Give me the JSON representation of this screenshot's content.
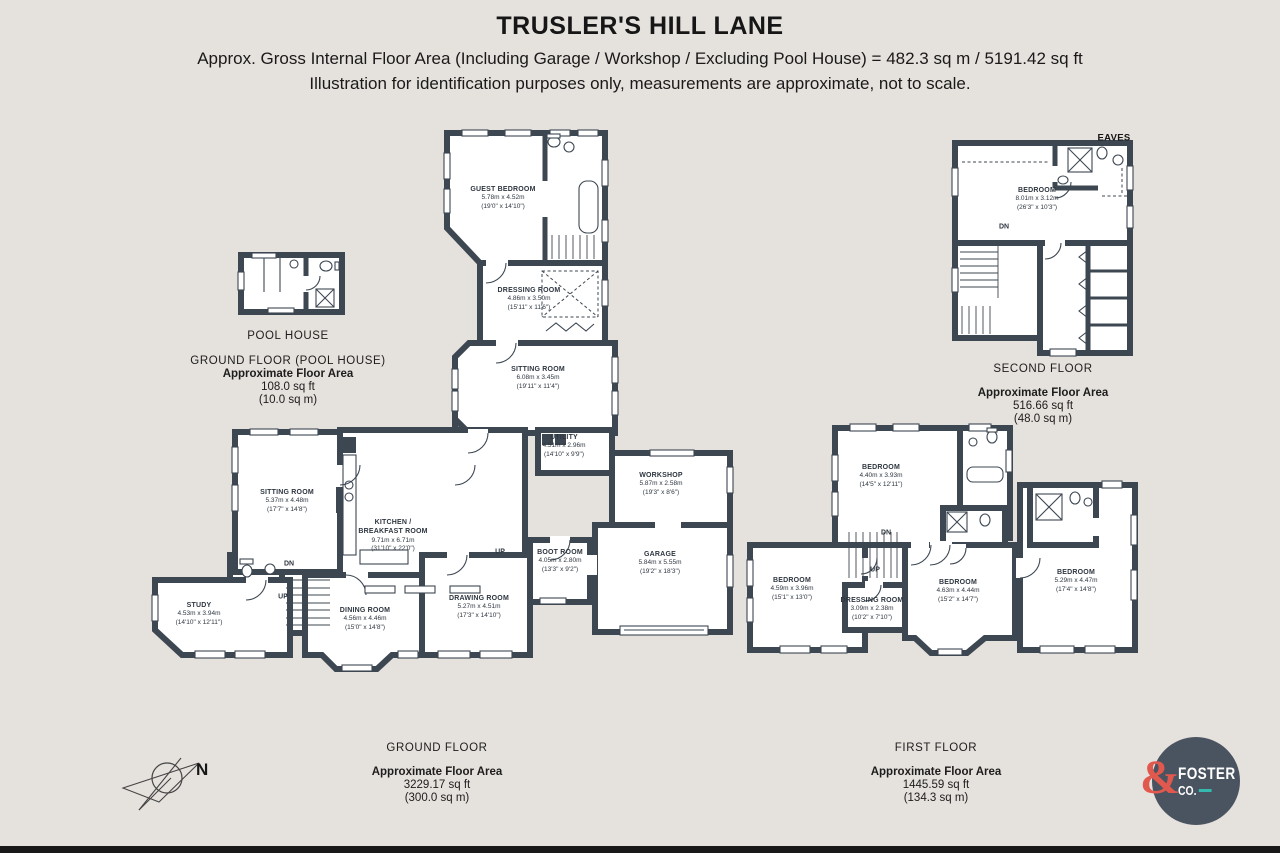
{
  "header": {
    "title": "TRUSLER'S HILL LANE",
    "line1": "Approx. Gross Internal Floor Area (Including Garage / Workshop / Excluding Pool House) = 482.3 sq m / 5191.42 sq ft",
    "line2": "Illustration for identification purposes only, measurements are approximate, not to scale."
  },
  "floors": {
    "pool_house": {
      "name": "POOL HOUSE",
      "floor_label": "GROUND FLOOR (POOL HOUSE)",
      "area_heading": "Approximate Floor Area",
      "area_ft": "108.0 sq ft",
      "area_m": "(10.0 sq m)"
    },
    "ground": {
      "floor_label": "GROUND FLOOR",
      "area_heading": "Approximate Floor Area",
      "area_ft": "3229.17 sq ft",
      "area_m": "(300.0 sq m)"
    },
    "first": {
      "floor_label": "FIRST FLOOR",
      "area_heading": "Approximate Floor Area",
      "area_ft": "1445.59 sq ft",
      "area_m": "(134.3 sq m)"
    },
    "second": {
      "floor_label": "SECOND FLOOR",
      "area_heading": "Approximate Floor Area",
      "area_ft": "516.66 sq ft",
      "area_m": "(48.0 sq m)"
    }
  },
  "rooms": {
    "guest_bedroom": {
      "name": "GUEST BEDROOM",
      "dims_m": "5.78m x 4.52m",
      "dims_ft": "(19'0\" x 14'10\")"
    },
    "dressing_gf": {
      "name": "DRESSING ROOM",
      "dims_m": "4.86m x 3.50m",
      "dims_ft": "(15'11\" x 11'6\")"
    },
    "sitting_mid": {
      "name": "SITTING ROOM",
      "dims_m": "6.08m x 3.45m",
      "dims_ft": "(19'11\" x 11'4\")"
    },
    "utility": {
      "name": "UTILITY",
      "dims_m": "4.51m x 2.96m",
      "dims_ft": "(14'10\" x 9'9\")"
    },
    "workshop": {
      "name": "WORKSHOP",
      "dims_m": "5.87m x 2.58m",
      "dims_ft": "(19'3\" x 8'6\")"
    },
    "sitting_left": {
      "name": "SITTING ROOM",
      "dims_m": "5.37m x 4.48m",
      "dims_ft": "(17'7\" x 14'8\")"
    },
    "kitchen": {
      "name": "KITCHEN / BREAKFAST ROOM",
      "dims_m": "9.71m x 6.71m",
      "dims_ft": "(31'10\" x 22'0\")"
    },
    "boot_room": {
      "name": "BOOT ROOM",
      "dims_m": "4.05m x 2.80m",
      "dims_ft": "(13'3\" x 9'2\")"
    },
    "garage": {
      "name": "GARAGE",
      "dims_m": "5.84m x 5.55m",
      "dims_ft": "(19'2\" x 18'3\")"
    },
    "study": {
      "name": "STUDY",
      "dims_m": "4.53m x 3.94m",
      "dims_ft": "(14'10\" x 12'11\")"
    },
    "dining": {
      "name": "DINING ROOM",
      "dims_m": "4.56m x 4.46m",
      "dims_ft": "(15'0\" x 14'8\")"
    },
    "drawing": {
      "name": "DRAWING ROOM",
      "dims_m": "5.27m x 4.51m",
      "dims_ft": "(17'3\" x 14'10\")"
    },
    "bedroom_second": {
      "name": "BEDROOM",
      "dims_m": "8.01m x 3.12m",
      "dims_ft": "(26'3\" x 10'3\")"
    },
    "bedroom_one": {
      "name": "BEDROOM",
      "dims_m": "4.40m x 3.93m",
      "dims_ft": "(14'5\" x 12'11\")"
    },
    "bedroom_two": {
      "name": "BEDROOM",
      "dims_m": "4.59m x 3.96m",
      "dims_ft": "(15'1\" x 13'0\")"
    },
    "dressing_ff": {
      "name": "DRESSING ROOM",
      "dims_m": "3.09m x 2.38m",
      "dims_ft": "(10'2\" x 7'10\")"
    },
    "bedroom_three": {
      "name": "BEDROOM",
      "dims_m": "4.63m x 4.44m",
      "dims_ft": "(15'2\" x 14'7\")"
    },
    "bedroom_four": {
      "name": "BEDROOM",
      "dims_m": "5.29m x 4.47m",
      "dims_ft": "(17'4\" x 14'8\")"
    }
  },
  "annotations": {
    "up": "UP",
    "dn": "DN",
    "eaves": "EAVES",
    "north": "N"
  },
  "logo": {
    "ampersand": "&",
    "name": "FOSTER",
    "co": "CO."
  },
  "colors": {
    "wall": "#3d4752",
    "background": "#e5e1dd",
    "logo_bg": "#4a5360",
    "logo_red": "#e0584e",
    "logo_teal": "#35b8ad"
  }
}
